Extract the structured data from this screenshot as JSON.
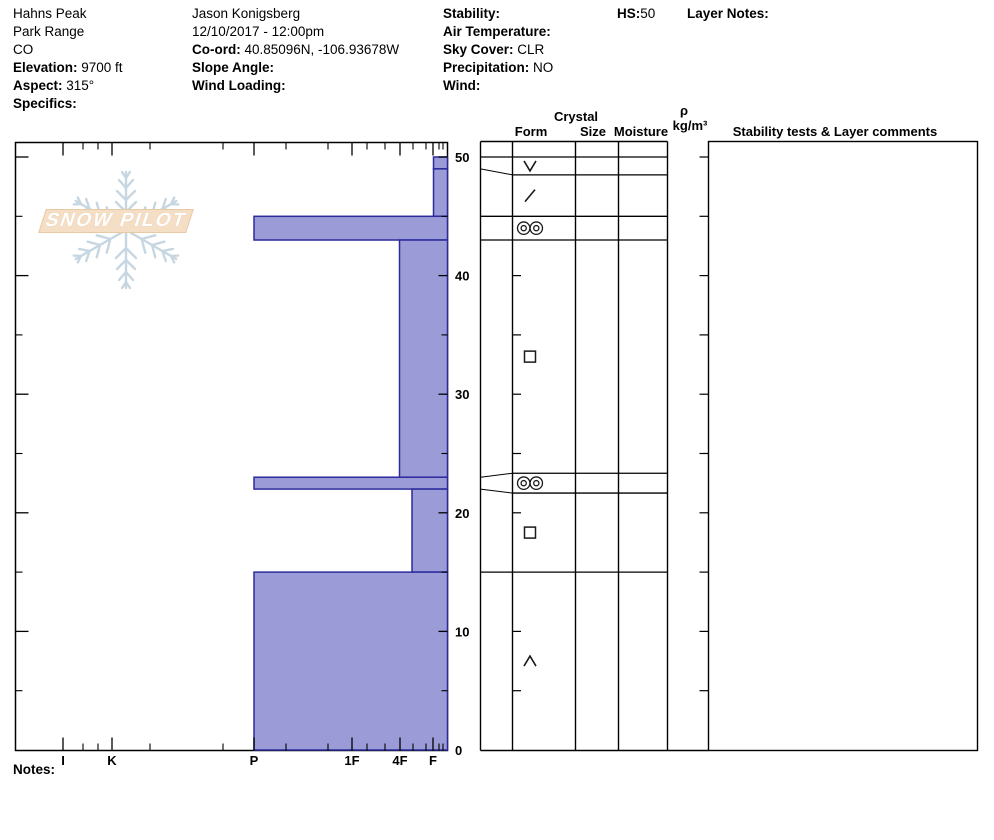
{
  "header": {
    "columns": [
      {
        "x": 13,
        "lines": [
          {
            "t": "Hahns Peak"
          },
          {
            "t": "Park Range"
          },
          {
            "t": "CO"
          },
          {
            "b": "Elevation:",
            "t": " 9700 ft"
          },
          {
            "b": "Aspect:",
            "t": " 315°"
          },
          {
            "b": "Specifics:",
            "t": ""
          }
        ]
      },
      {
        "x": 192,
        "lines": [
          {
            "t": "Jason Konigsberg"
          },
          {
            "t": "12/10/2017 - 12:00pm"
          },
          {
            "b": "Co-ord:",
            "t": " 40.85096N, -106.93678W"
          },
          {
            "b": "Slope Angle:",
            "t": ""
          },
          {
            "b": "Wind Loading:",
            "t": ""
          }
        ]
      },
      {
        "x": 443,
        "lines": [
          {
            "b": "Stability:",
            "t": ""
          },
          {
            "b": "Air Temperature:",
            "t": ""
          },
          {
            "b": "Sky Cover:",
            "t": " CLR"
          },
          {
            "b": "Precipitation:",
            "t": " NO"
          },
          {
            "b": "Wind:",
            "t": ""
          }
        ]
      },
      {
        "x": 617,
        "lines": [
          {
            "b": "HS:",
            "t": "50"
          }
        ]
      },
      {
        "x": 687,
        "lines": [
          {
            "b": "Layer Notes:",
            "t": ""
          }
        ]
      }
    ]
  },
  "logo": {
    "text": "SNOW PILOT"
  },
  "table_header": {
    "form": "Form",
    "crystal": "Crystal",
    "size": "Size",
    "moisture": "Moisture",
    "rho": "ρ",
    "rho_units": "kg/m³",
    "comments": "Stability tests & Layer comments"
  },
  "notes_label": "Notes:",
  "chart_data": {
    "type": "bar",
    "orientation": "horizontal",
    "title": "",
    "xlabel": "",
    "ylabel": "",
    "ylim": [
      0,
      50
    ],
    "hs": 50,
    "grid": false,
    "y_major_ticks": [
      0,
      10,
      20,
      30,
      40,
      50
    ],
    "y_minor_ticks": [
      5,
      15,
      25,
      35,
      45
    ],
    "hardness_axis": {
      "labels": [
        "I",
        "K",
        "P",
        "1F",
        "4F",
        "F"
      ],
      "px": [
        63,
        112,
        254,
        352,
        400,
        433
      ],
      "minor_px": [
        83,
        98,
        150,
        223,
        286,
        328,
        367,
        385,
        413,
        426,
        439,
        443
      ]
    },
    "hardness_px": {
      "I": 63,
      "K": 112,
      "P": 254,
      "1F": 352,
      "4F": 399.5,
      "4F-": 412,
      "F": 433.5
    },
    "layers": [
      {
        "top": 50,
        "bottom": 49,
        "hardness": "F",
        "grain_form": "SH"
      },
      {
        "top": 49,
        "bottom": 45,
        "hardness": "F",
        "grain_form": "DF"
      },
      {
        "top": 45,
        "bottom": 43,
        "hardness": "P",
        "grain_form": "MFcr"
      },
      {
        "top": 43,
        "bottom": 23,
        "hardness": "4F",
        "grain_form": "FC"
      },
      {
        "top": 23,
        "bottom": 22,
        "hardness": "P",
        "grain_form": "MFcr"
      },
      {
        "top": 22,
        "bottom": 15,
        "hardness": "4F-",
        "grain_form": "FC"
      },
      {
        "top": 15,
        "bottom": 0,
        "hardness": "P",
        "grain_form": "DH"
      }
    ],
    "colors": {
      "bar_fill": "#9B9BD7",
      "bar_border": "#2B2B9B",
      "line": "#000000",
      "logo_flake": "#C7D7E2",
      "logo_banner": "#F5DEC6"
    }
  }
}
